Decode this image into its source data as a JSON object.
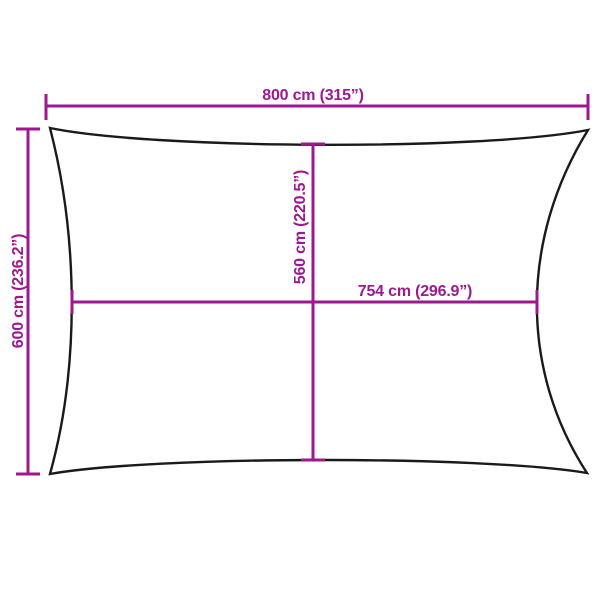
{
  "diagram": {
    "type": "product-dimension-diagram",
    "subject": "rectangular shade sail",
    "background_color": "#ffffff",
    "outline_color": "#1a1a1a",
    "accent_color": "#9e188e",
    "dimensions": {
      "outer_width": {
        "label": "800 cm (315”)",
        "value_cm": 800,
        "value_in": 315
      },
      "outer_height": {
        "label": "600 cm (236.2”)",
        "value_cm": 600,
        "value_in": 236.2
      },
      "inner_height": {
        "label": "560 cm (220.5”)",
        "value_cm": 560,
        "value_in": 220.5
      },
      "inner_width": {
        "label": "754 cm (296.9”)",
        "value_cm": 754,
        "value_in": 296.9
      }
    }
  }
}
